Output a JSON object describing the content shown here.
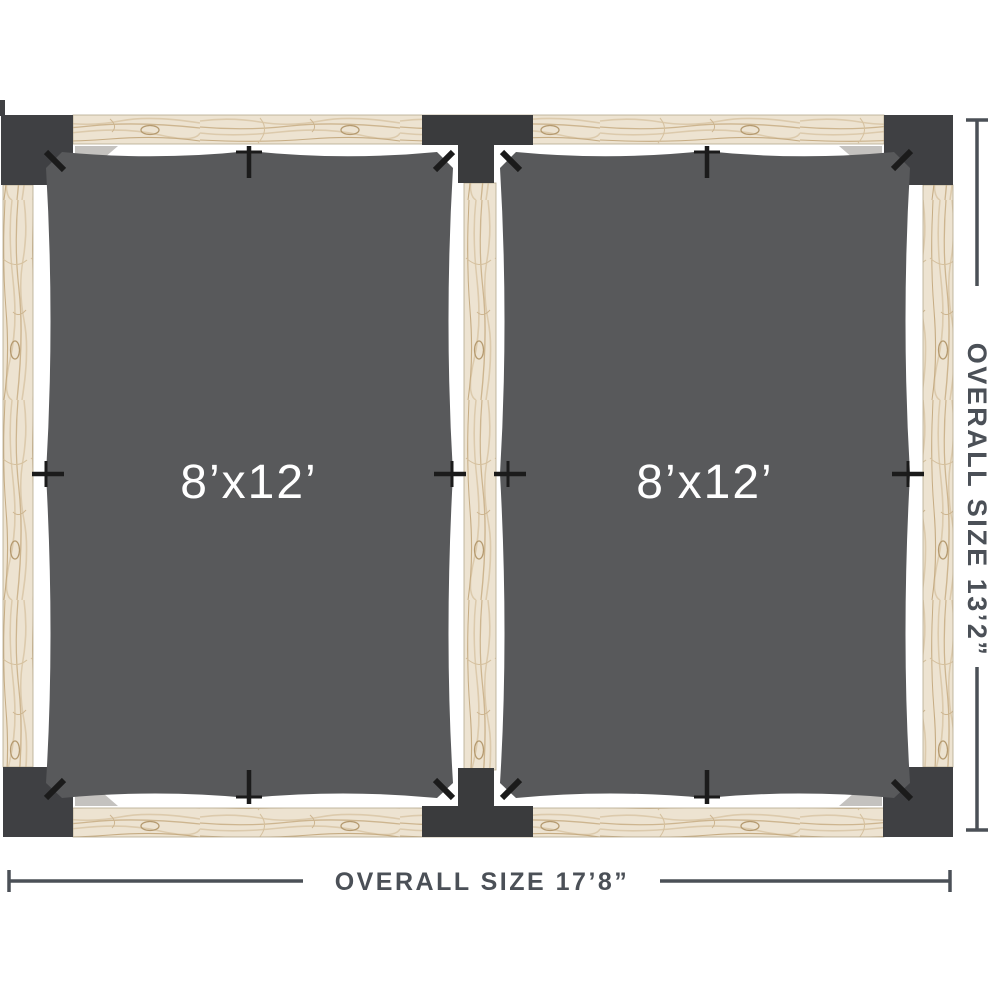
{
  "diagram": {
    "canopies": [
      {
        "label": "8’x12’"
      },
      {
        "label": "8’x12’"
      }
    ],
    "dimensions": {
      "width_label": "OVERALL SIZE 17’8”",
      "height_label": "OVERALL SIZE 13’2”"
    },
    "colors": {
      "background": "#FFFFFF",
      "canopy": "#58595B",
      "post": "#3F4043",
      "connector": "#3A3B3D",
      "wood": "#EDE3D1",
      "hook": "#1B1B1B",
      "bracket": "#C4C2BF",
      "dimension": "#4B5057",
      "label_text": "#FFFFFF"
    }
  }
}
